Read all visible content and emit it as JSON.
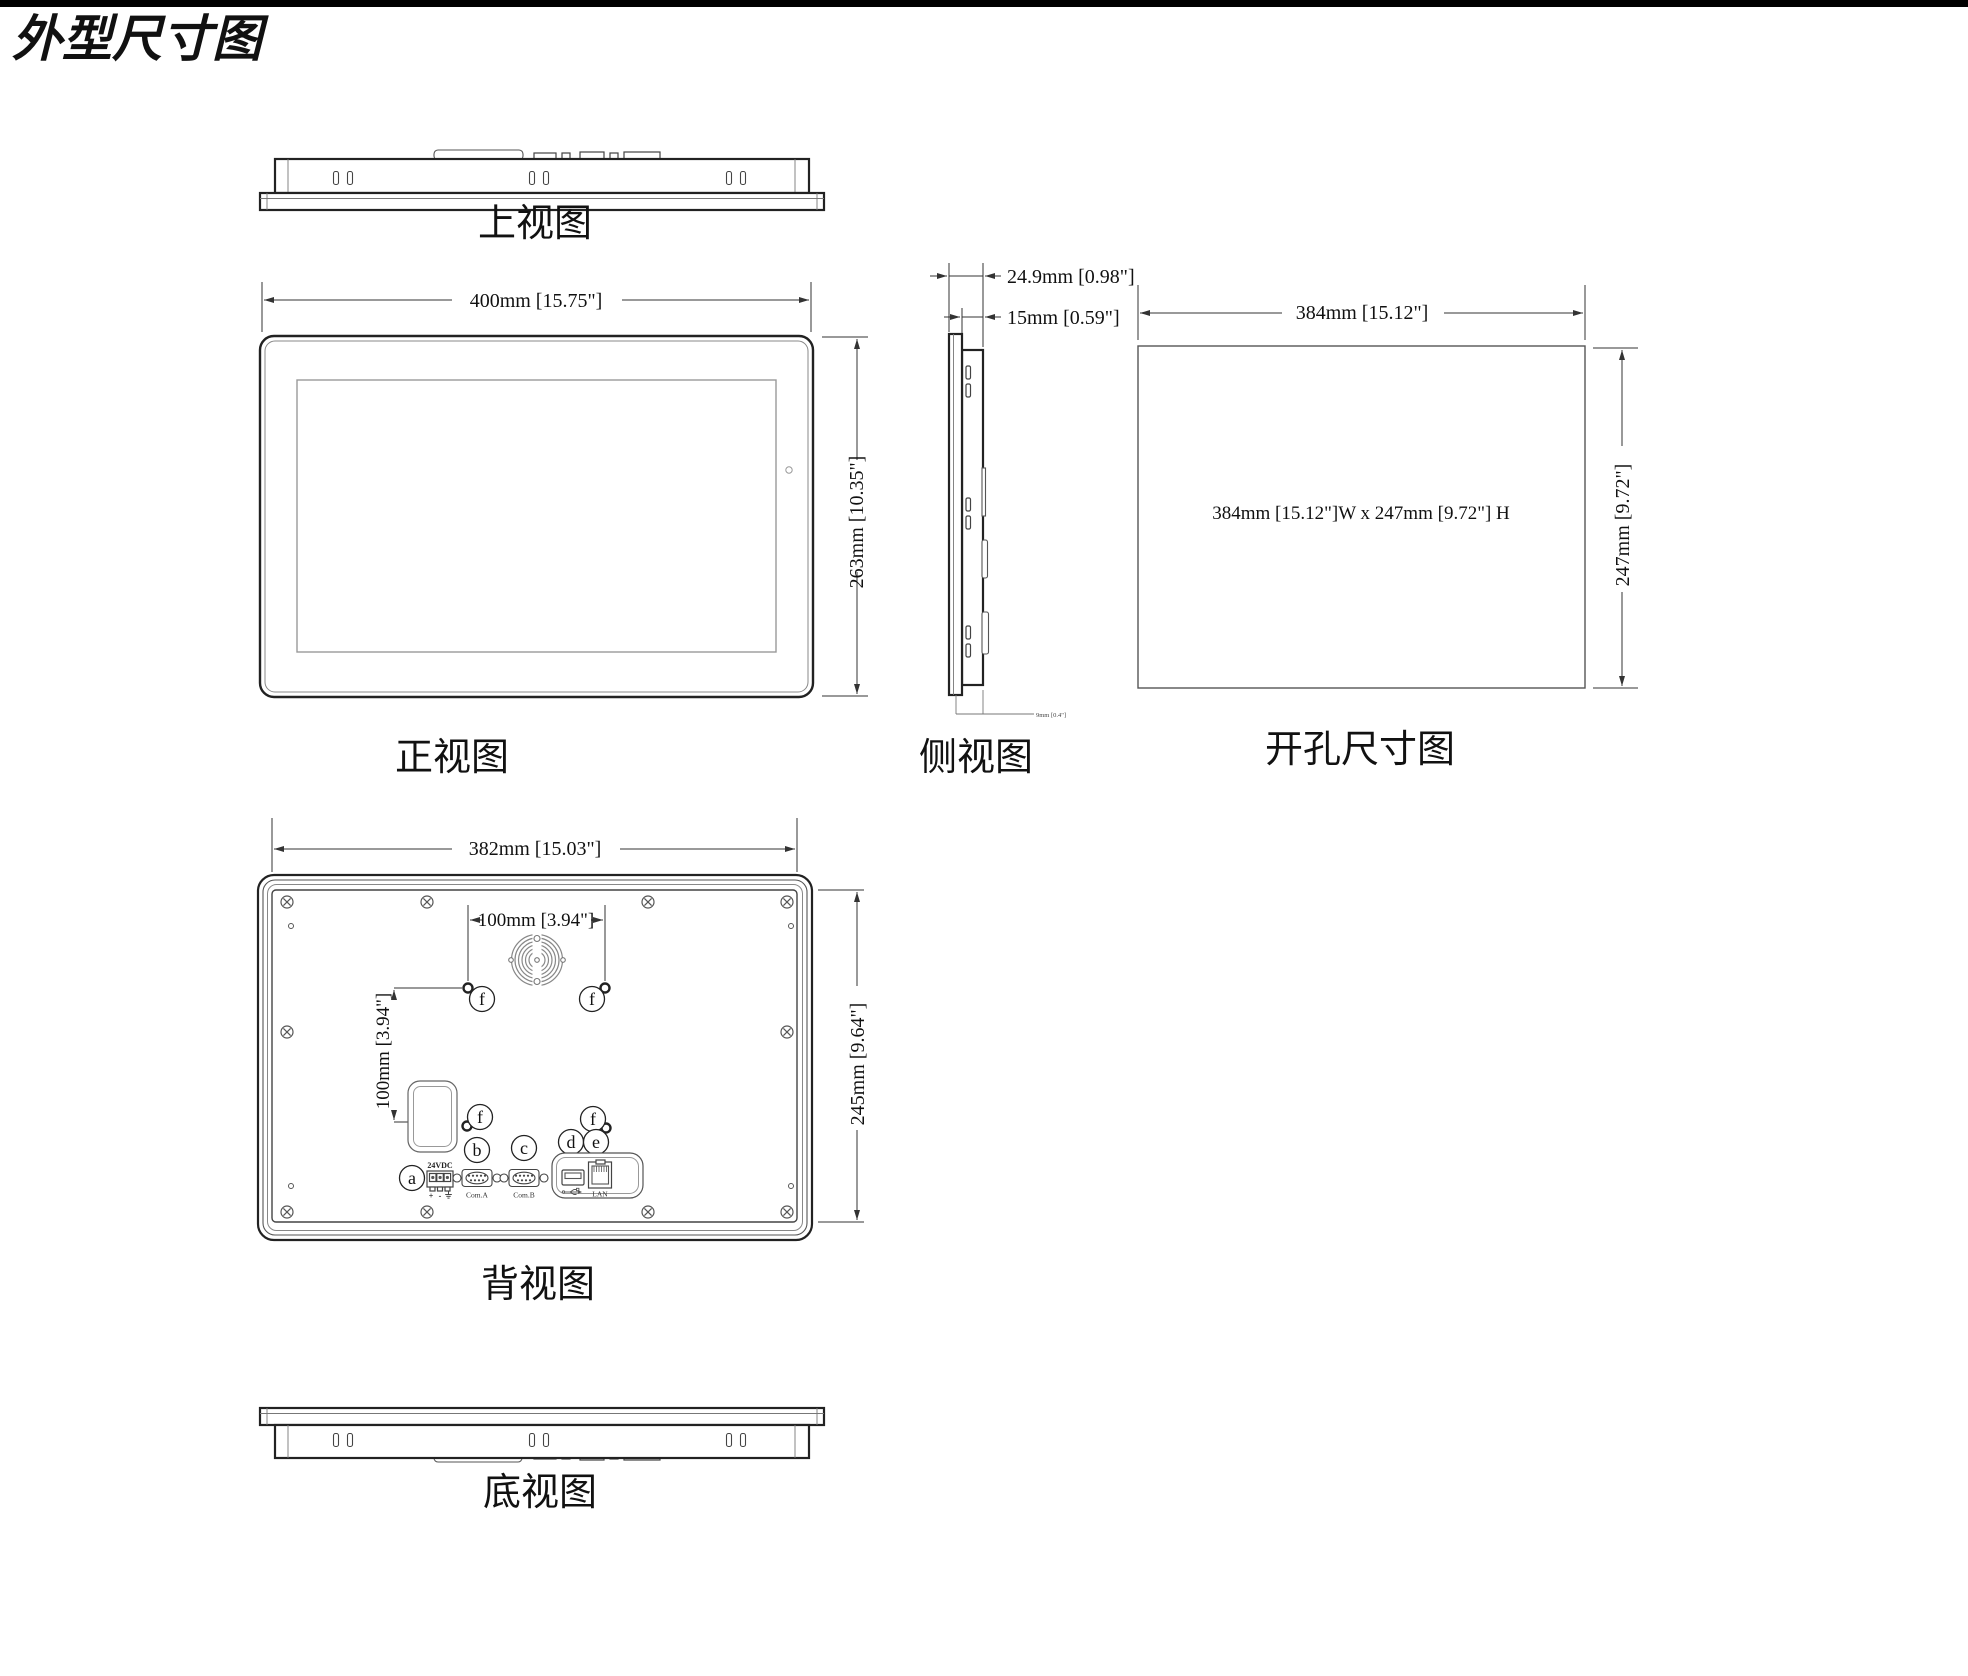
{
  "title": "外型尺寸图",
  "top_view": {
    "label": "上视图"
  },
  "front_view": {
    "label": "正视图",
    "width": "400mm [15.75\"]",
    "height": "263mm [10.35\"]"
  },
  "side_view": {
    "label": "侧视图",
    "depth_total": "24.9mm [0.98\"]",
    "depth_body": "15mm [0.59\"]",
    "depth_detail": "9mm [0.4\"]"
  },
  "cutout_view": {
    "label": "开孔尺寸图",
    "width": "384mm [15.12\"]",
    "height": "247mm [9.72\"]",
    "note": "384mm [15.12\"]W x 247mm [9.72\"] H"
  },
  "back_view": {
    "label": "背视图",
    "width": "382mm [15.03\"]",
    "height": "245mm [9.64\"]",
    "vesa_width": "100mm [3.94\"]",
    "vesa_height": "100mm [3.94\"]",
    "power_label": "24VDC",
    "power_plus": "+",
    "power_minus": "-",
    "com_a_label": "Com.A",
    "com_b_label": "Com.B",
    "lan_label": "LAN",
    "callouts": {
      "a": "a",
      "b": "b",
      "c": "c",
      "d": "d",
      "e": "e",
      "f": "f"
    }
  },
  "bottom_view": {
    "label": "底视图"
  }
}
